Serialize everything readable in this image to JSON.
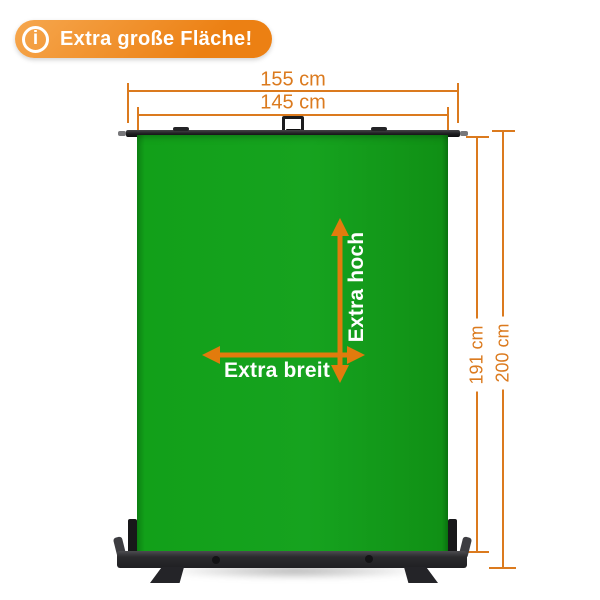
{
  "badge": {
    "icon_glyph": "i",
    "label": "Extra große Fläche!"
  },
  "dimensions": {
    "outer_width": "155 cm",
    "inner_width": "145 cm",
    "screen_height": "191 cm",
    "total_height": "200 cm"
  },
  "annotations": {
    "height_label": "Extra hoch",
    "width_label": "Extra breit"
  },
  "colors": {
    "accent_orange": "#DB7A1E",
    "arrow_orange": "#E27B0D",
    "badge_gradient_start": "#F6A74E",
    "badge_gradient_end": "#EC8013",
    "screen_green": "#12A019",
    "frame_dark": "#1D1D1F",
    "base_gray": "#2B2B2E"
  }
}
